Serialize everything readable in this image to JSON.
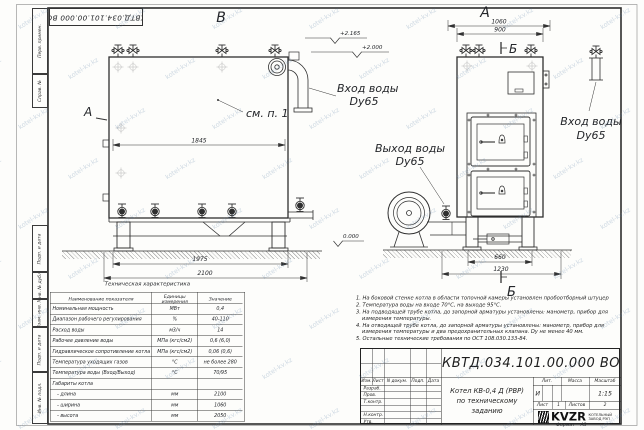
{
  "watermark": "kotel-kv.kz",
  "colors": {
    "ink": "#24262a",
    "paper": "#fdfdfb",
    "watermark": "#6084a8"
  },
  "margin_column": [
    "Перв. примен.",
    "Справ. №",
    "Подп. и дата",
    "Инв. № дубл.",
    "Взам. инв. №",
    "Подп. и дата",
    "Инв. № подл."
  ],
  "stamp_top": "КВТД.034.101.00.000  ВО",
  "drawing": {
    "view_b": "В",
    "view_a": "А",
    "view_arrow": "А",
    "section_b_top": "Б",
    "section_b_bottom": "Б",
    "see_note": "см. п. 1",
    "inlet_line1": "Вход воды",
    "inlet_line2": "Dy65",
    "outlet_line1": "Выход воды",
    "outlet_line2": "Dy65",
    "inlet2_line1": "Вход воды",
    "inlet2_line2": "Dy65",
    "elev_1": "+2.165",
    "elev_2": "+2.000",
    "elev_0": "0.000",
    "dim_1845": "1845",
    "dim_1975": "1975",
    "dim_2100": "2100",
    "dim_1060": "1060",
    "dim_900": "900",
    "dim_660": "660",
    "dim_1230": "1230"
  },
  "tech_table": {
    "title": "Техническая характеристика",
    "col_headers": [
      "Наименование показателя",
      "Единицы\nизмерения",
      "Значение"
    ],
    "rows": [
      {
        "name": "Номинальная мощность",
        "unit": "МВт",
        "value": "0,4"
      },
      {
        "name": "Диапазон рабочего регулирования",
        "unit": "%",
        "value": "40-110"
      },
      {
        "name": "Расход воды",
        "unit": "м3/ч",
        "value": "14"
      },
      {
        "name": "Рабочее давление воды",
        "unit": "МПа (кгс/см2)",
        "value": "0,6 (6,0)"
      },
      {
        "name": "Гидравлическое сопротивление котла",
        "unit": "МПа (кгс/см2)",
        "value": "0,06 (0,6)"
      },
      {
        "name": "Температура уходящих газов",
        "unit": "°С",
        "value": "не более 280"
      },
      {
        "name": "Температура воды (Вход/Выход)",
        "unit": "°С",
        "value": "70/95"
      },
      {
        "name": "Габариты котла",
        "unit": "",
        "value": ""
      },
      {
        "name": "   - длина",
        "unit": "мм",
        "value": "2100"
      },
      {
        "name": "   - ширина",
        "unit": "мм",
        "value": "1060"
      },
      {
        "name": "   - высота",
        "unit": "мм",
        "value": "2050"
      }
    ]
  },
  "notes": [
    "1.  На боковой стенке котла в области топочной камеры установлен пробоотборный штуцер",
    "2.  Температура воды на входе 70°С, на выходе 95°С.",
    "3.  На подводящей трубе котла, до запорной арматуры установлены: манометр, прибор для измерения температуры.",
    "4.  На отводящей трубе котла, до запорной арматуры установлены: манометр, прибор для измерения температуры и два предохранительных клапана. Dу не менее 40 мм.",
    "5.  Остальные технические требования по ОСТ 108.030.133-84."
  ],
  "title_block": {
    "doc_number": "КВТД.034.101.00.000  ВО",
    "title_line1": "Котел  КВ-0,4  Д  (РВР)",
    "title_line2": "по техническому заданию",
    "header_cells": [
      "Изм.",
      "Лист",
      "N докум.",
      "Подп.",
      "Дата"
    ],
    "sign_rows": [
      "Разраб.",
      "Пров.",
      "Т.контр.",
      "",
      "Н.контр.",
      "Утв."
    ],
    "lit_label": "Лит.",
    "mass_label": "Масса",
    "scale_label": "Масштаб",
    "lit_value": "И",
    "scale_value": "1:15",
    "sheet_label": "Лист",
    "sheet_value": "1",
    "sheets_label": "Листов",
    "sheets_value": "2",
    "logo_text": "KVZR",
    "company_line1": "КОТЕЛЬНЫЙ",
    "company_line2": "ЗАВОД РЭП",
    "format_label": "Формат",
    "format_value": "А3"
  }
}
